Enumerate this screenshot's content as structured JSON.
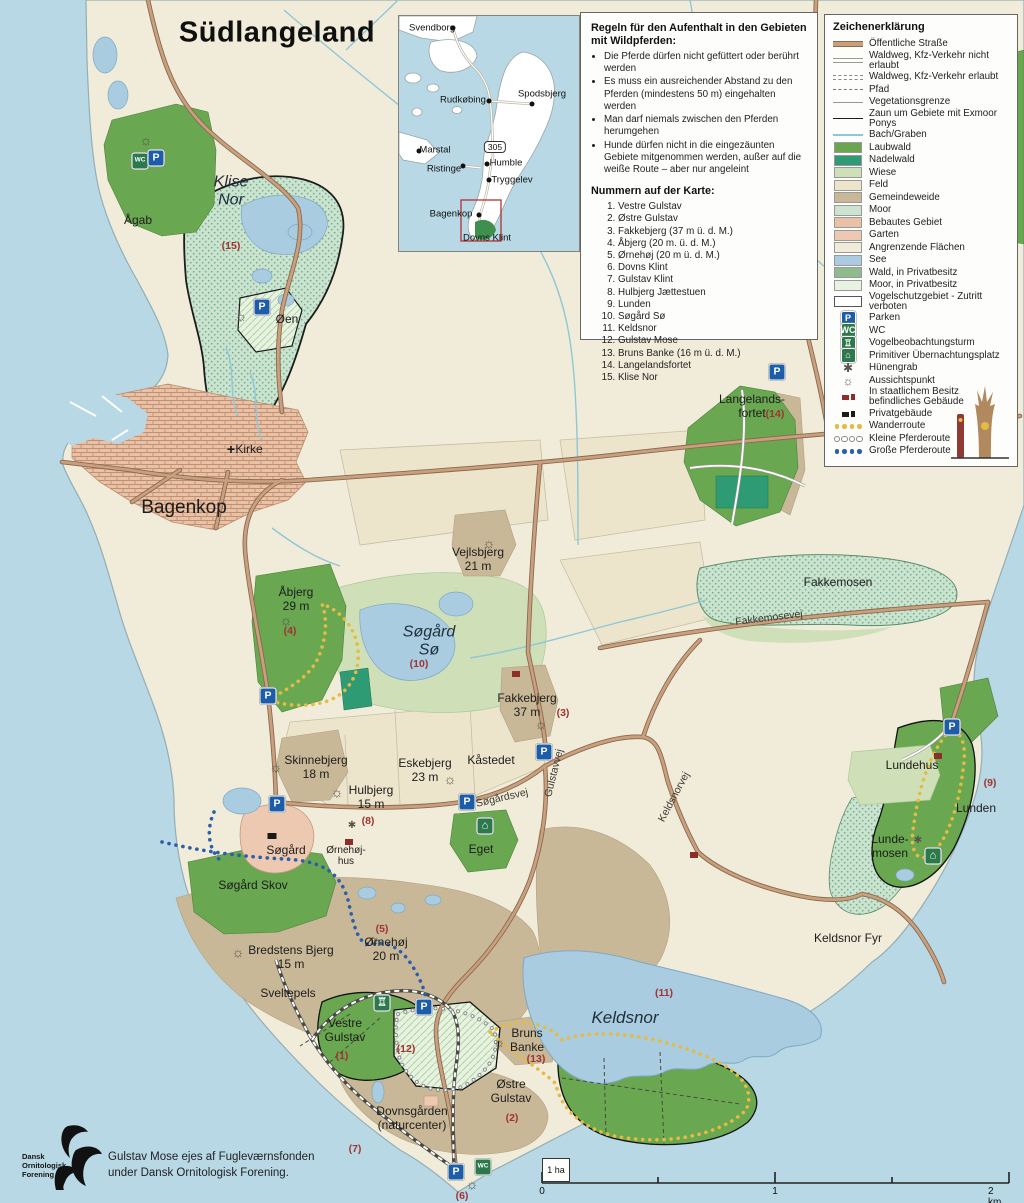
{
  "colors": {
    "sea": "#b7d8e4",
    "land": "#f1ecd9",
    "laubwald": "#69a750",
    "nadelwald": "#2f9b74",
    "wiese": "#cfe0b8",
    "feld": "#ece5cc",
    "gemeindeweide": "#c9b897",
    "moor": "#cbe3cf",
    "bebaut": "#e9c2a6",
    "garten": "#ecc9b0",
    "see": "#a9cce0",
    "wald_privat": "#8dbb8d",
    "road": "#c9a07e",
    "road_edge": "#8a6950",
    "parking_blue": "#1d5ca6",
    "wc_green": "#2c7a4c",
    "red_number": "#a03432",
    "route_yellow": "#e3bb45",
    "route_blue": "#2b5fa7"
  },
  "icon_defs": {
    "parking": {
      "glyph": "P",
      "bg": "#1d5ca6",
      "fg": "#ffffff"
    },
    "wc": {
      "glyph": "WC",
      "bg": "#2c7a4c",
      "fg": "#ffffff"
    },
    "tower": {
      "glyph": "♖",
      "bg": "#2c7a4c",
      "fg": "#ffffff"
    },
    "shelter": {
      "glyph": "⌂",
      "bg": "#2c7a4c",
      "fg": "#ffffff"
    },
    "viewpoint": {
      "glyph": "☼"
    },
    "huenengrab": {
      "glyph": "✱"
    },
    "church": {
      "glyph": "+"
    },
    "state-building": {
      "bg": "#8f2d2b"
    },
    "private-building": {
      "bg": "#1a1a1a"
    }
  },
  "inset": {
    "route_badge": "305",
    "towns": [
      {
        "name": "Svendborg",
        "lx": 33,
        "ly": 12,
        "dx": 54,
        "dy": 12
      },
      {
        "name": "Rudkøbing",
        "lx": 64,
        "ly": 84,
        "dx": 90,
        "dy": 85
      },
      {
        "name": "Spodsbjerg",
        "lx": 143,
        "ly": 78,
        "dx": 133,
        "dy": 88
      },
      {
        "name": "Marstal",
        "lx": 36,
        "ly": 134,
        "dx": 20,
        "dy": 135
      },
      {
        "name": "Ristinge",
        "lx": 45,
        "ly": 153,
        "dx": 64,
        "dy": 150
      },
      {
        "name": "Humble",
        "lx": 107,
        "ly": 147,
        "dx": 88,
        "dy": 148
      },
      {
        "name": "Tryggelev",
        "lx": 113,
        "ly": 164,
        "dx": 90,
        "dy": 164
      },
      {
        "name": "Bagenkop",
        "lx": 52,
        "ly": 198,
        "dx": 80,
        "dy": 199
      },
      {
        "name": "Dovns Klint",
        "lx": 88,
        "ly": 222,
        "dx": null,
        "dy": null
      }
    ]
  },
  "rules": {
    "heading": "Regeln für den Aufenthalt in den Gebieten mit Wildpferden:",
    "bullets": [
      "Die Pferde dürfen nicht gefüttert oder berührt werden",
      "Es muss ein ausreichender Abstand zu den Pferden (mindestens 50 m) eingehalten werden",
      "Man darf niemals zwischen den Pferden herumgehen",
      "Hunde dürfen nicht in die eingezäunten Gebiete mitgenommen werden, außer auf die weiße Route – aber nur angeleint"
    ],
    "numbers_heading": "Nummern auf der Karte:",
    "numbers": [
      "Vestre Gulstav",
      "Østre Gulstav",
      "Fakkebjerg (37 m ü. d. M.)",
      "Åbjerg (20 m. ü. d. M.)",
      "Ørnehøj (20 m ü. d. M.)",
      "Dovns Klint",
      "Gulstav Klint",
      "Hulbjerg Jættestuen",
      "Lunden",
      "Søgård Sø",
      "Keldsnor",
      "Gulstav Mose",
      "Bruns Banke (16 m ü. d. M.)",
      "Langelandsfortet",
      "Klise Nor"
    ]
  },
  "legend": {
    "heading": "Zeichenerklärung",
    "items": [
      {
        "label": "Öffentliche Straße",
        "sw": {
          "k": "road"
        }
      },
      {
        "label": "Waldweg, Kfz-Verkehr nicht erlaubt",
        "sw": {
          "k": "wald"
        }
      },
      {
        "label": "Waldweg, Kfz-Verkehr erlaubt",
        "sw": {
          "k": "waldk"
        }
      },
      {
        "label": "Pfad",
        "sw": {
          "k": "pfad"
        }
      },
      {
        "label": "Vegetationsgrenze",
        "sw": {
          "k": "veg"
        }
      },
      {
        "label": "Zaun um Gebiete mit Exmoor Ponys",
        "sw": {
          "k": "zaun"
        }
      },
      {
        "label": "Bach/Graben",
        "sw": {
          "k": "bach"
        }
      },
      {
        "label": "Laubwald",
        "sw": {
          "k": "fill",
          "c": "#6aa64f"
        }
      },
      {
        "label": "Nadelwald",
        "sw": {
          "k": "fill",
          "c": "#2f9b74"
        }
      },
      {
        "label": "Wiese",
        "sw": {
          "k": "fill",
          "c": "#cfe0b8"
        }
      },
      {
        "label": "Feld",
        "sw": {
          "k": "fill",
          "c": "#ece5cc"
        }
      },
      {
        "label": "Gemeindeweide",
        "sw": {
          "k": "fill",
          "c": "#c9b897"
        }
      },
      {
        "label": "Moor",
        "sw": {
          "k": "fill",
          "c": "#cbe3cf",
          "p": "dots"
        }
      },
      {
        "label": "Bebautes Gebiet",
        "sw": {
          "k": "fill",
          "c": "#e9c2a6",
          "p": "brick"
        }
      },
      {
        "label": "Garten",
        "sw": {
          "k": "fill",
          "c": "#ecc9b0"
        }
      },
      {
        "label": "Angrenzende Flächen",
        "sw": {
          "k": "fill",
          "c": "#f1ecd9"
        }
      },
      {
        "label": "See",
        "sw": {
          "k": "fill",
          "c": "#a9cce0"
        }
      },
      {
        "label": "Wald, in Privatbesitz",
        "sw": {
          "k": "fill",
          "c": "#8dbb8d"
        }
      },
      {
        "label": "Moor, in Privatbesitz",
        "sw": {
          "k": "fill",
          "c": "#e7f2e0",
          "p": "hatchg"
        }
      },
      {
        "label": "Vogelschutzgebiet - Zutritt verboten",
        "sw": {
          "k": "fill",
          "c": "#ffffff",
          "p": "diag",
          "b": 1
        }
      },
      {
        "label": "Parken",
        "sw": {
          "k": "icon",
          "t": "parking"
        }
      },
      {
        "label": "WC",
        "sw": {
          "k": "icon",
          "t": "wc"
        }
      },
      {
        "label": "Vogelbeobachtungsturm",
        "sw": {
          "k": "icon",
          "t": "tower"
        }
      },
      {
        "label": "Primitiver Übernachtungsplatz",
        "sw": {
          "k": "icon",
          "t": "shelter"
        }
      },
      {
        "label": "Hünengrab",
        "sw": {
          "k": "sym",
          "t": "huenengrab"
        }
      },
      {
        "label": "Aussichtspunkt",
        "sw": {
          "k": "sym",
          "t": "viewpoint"
        }
      },
      {
        "label": "In staatlichem Besitz\nbefindliches Gebäude",
        "sw": {
          "k": "bld",
          "c": "#8f2d2b"
        }
      },
      {
        "label": "Privatgebäude",
        "sw": {
          "k": "bld",
          "c": "#1a1a1a"
        }
      },
      {
        "label": "Wanderroute",
        "sw": {
          "k": "dots",
          "c": "#e3bb45"
        }
      },
      {
        "label": "Kleine Pferderoute",
        "sw": {
          "k": "dots",
          "c": "#ffffff",
          "ring": "#8a8a8a"
        }
      },
      {
        "label": "Große Pferderoute",
        "sw": {
          "k": "dots",
          "c": "#2b5fa7"
        }
      }
    ]
  },
  "map": {
    "labels": [
      {
        "text": "Südlangeland",
        "x": 277,
        "y": 33,
        "cls": "title",
        "name": "page-title"
      },
      {
        "text": "Klise\nNor",
        "x": 231,
        "y": 192,
        "cls": "water"
      },
      {
        "text": "Ågab",
        "x": 138,
        "y": 221,
        "cls": "place"
      },
      {
        "text": "(15)",
        "x": 231,
        "y": 246,
        "cls": "num"
      },
      {
        "text": "Øen",
        "x": 287,
        "y": 320,
        "cls": "place"
      },
      {
        "text": "Kirke",
        "x": 249,
        "y": 450,
        "cls": "place"
      },
      {
        "text": "Bagenkop",
        "x": 184,
        "y": 508,
        "cls": "town"
      },
      {
        "text": "Vejlsbjerg\n21 m",
        "x": 478,
        "y": 560,
        "cls": "place"
      },
      {
        "text": "Åbjerg\n29 m",
        "x": 296,
        "y": 600,
        "cls": "place"
      },
      {
        "text": "(4)",
        "x": 290,
        "y": 631,
        "cls": "num"
      },
      {
        "text": "Søgård\nSø",
        "x": 429,
        "y": 642,
        "cls": "water"
      },
      {
        "text": "(10)",
        "x": 419,
        "y": 664,
        "cls": "num"
      },
      {
        "text": "Fakkebjerg\n37 m",
        "x": 527,
        "y": 706,
        "cls": "place"
      },
      {
        "text": "(3)",
        "x": 563,
        "y": 713,
        "cls": "num"
      },
      {
        "text": "Fakkemosen",
        "x": 838,
        "y": 583,
        "cls": "place"
      },
      {
        "text": "Fakkemosevej",
        "x": 769,
        "y": 618,
        "cls": "roadlbl",
        "rot": -7
      },
      {
        "text": "Langelands-\nfortet",
        "x": 752,
        "y": 407,
        "cls": "place"
      },
      {
        "text": "(14)",
        "x": 775,
        "y": 414,
        "cls": "num"
      },
      {
        "text": "Skinnebjerg\n18 m",
        "x": 316,
        "y": 768,
        "cls": "place"
      },
      {
        "text": "Eskebjerg\n23 m",
        "x": 425,
        "y": 771,
        "cls": "place"
      },
      {
        "text": "Kåstedet",
        "x": 491,
        "y": 761,
        "cls": "place"
      },
      {
        "text": "Hulbjerg\n15 m",
        "x": 371,
        "y": 798,
        "cls": "place"
      },
      {
        "text": "(8)",
        "x": 368,
        "y": 821,
        "cls": "num"
      },
      {
        "text": "Søgårdsvej",
        "x": 502,
        "y": 798,
        "cls": "roadlbl",
        "rot": -13
      },
      {
        "text": "Gulstavvej",
        "x": 554,
        "y": 773,
        "cls": "roadlbl",
        "rot": -76
      },
      {
        "text": "Keldsnorvej",
        "x": 674,
        "y": 797,
        "cls": "roadlbl",
        "rot": -62
      },
      {
        "text": "Søgård",
        "x": 286,
        "y": 851,
        "cls": "place"
      },
      {
        "text": "Ørnehøj-\nhus",
        "x": 346,
        "y": 856,
        "cls": "small"
      },
      {
        "text": "Eget",
        "x": 481,
        "y": 850,
        "cls": "place"
      },
      {
        "text": "Søgård Skov",
        "x": 253,
        "y": 886,
        "cls": "place"
      },
      {
        "text": "Bredstens Bjerg\n15 m",
        "x": 291,
        "y": 958,
        "cls": "place"
      },
      {
        "text": "Ørnehøj\n20 m",
        "x": 386,
        "y": 950,
        "cls": "place"
      },
      {
        "text": "(5)",
        "x": 382,
        "y": 929,
        "cls": "num"
      },
      {
        "text": "Sveltepels",
        "x": 288,
        "y": 994,
        "cls": "place"
      },
      {
        "text": "Keldsnor Fyr",
        "x": 848,
        "y": 939,
        "cls": "place"
      },
      {
        "text": "Keldsnor",
        "x": 625,
        "y": 1018,
        "cls": "water-lg"
      },
      {
        "text": "(11)",
        "x": 664,
        "y": 993,
        "cls": "num"
      },
      {
        "text": "Lundehus",
        "x": 912,
        "y": 766,
        "cls": "place"
      },
      {
        "text": "Lunden",
        "x": 976,
        "y": 809,
        "cls": "place"
      },
      {
        "text": "(9)",
        "x": 990,
        "y": 783,
        "cls": "num"
      },
      {
        "text": "Lunde-\nmosen",
        "x": 890,
        "y": 847,
        "cls": "place"
      },
      {
        "text": "Vestre\nGulstav",
        "x": 345,
        "y": 1031,
        "cls": "place"
      },
      {
        "text": "(1)",
        "x": 342,
        "y": 1056,
        "cls": "num"
      },
      {
        "text": "(12)",
        "x": 406,
        "y": 1049,
        "cls": "num"
      },
      {
        "text": "Bruns\nBanke",
        "x": 527,
        "y": 1041,
        "cls": "place"
      },
      {
        "text": "(13)",
        "x": 536,
        "y": 1059,
        "cls": "num"
      },
      {
        "text": "Østre\nGulstav",
        "x": 511,
        "y": 1092,
        "cls": "place"
      },
      {
        "text": "(2)",
        "x": 512,
        "y": 1118,
        "cls": "num"
      },
      {
        "text": "Dovnsgården\n(naturcenter)",
        "x": 412,
        "y": 1119,
        "cls": "place"
      },
      {
        "text": "(7)",
        "x": 355,
        "y": 1149,
        "cls": "num"
      },
      {
        "text": "(6)",
        "x": 462,
        "y": 1196,
        "cls": "num"
      }
    ],
    "icons": [
      {
        "t": "wc",
        "x": 140,
        "y": 161
      },
      {
        "t": "parking",
        "x": 156,
        "y": 158
      },
      {
        "t": "viewpoint",
        "x": 146,
        "y": 140
      },
      {
        "t": "parking",
        "x": 262,
        "y": 307
      },
      {
        "t": "viewpoint",
        "x": 241,
        "y": 316
      },
      {
        "t": "church",
        "x": 231,
        "y": 449
      },
      {
        "t": "viewpoint",
        "x": 489,
        "y": 543
      },
      {
        "t": "viewpoint",
        "x": 286,
        "y": 620
      },
      {
        "t": "parking",
        "x": 268,
        "y": 696
      },
      {
        "t": "viewpoint",
        "x": 541,
        "y": 724
      },
      {
        "t": "state-building",
        "x": 516,
        "y": 674
      },
      {
        "t": "parking",
        "x": 777,
        "y": 372
      },
      {
        "t": "viewpoint",
        "x": 276,
        "y": 767
      },
      {
        "t": "viewpoint",
        "x": 337,
        "y": 792
      },
      {
        "t": "viewpoint",
        "x": 450,
        "y": 779
      },
      {
        "t": "huenengrab",
        "x": 352,
        "y": 826
      },
      {
        "t": "parking",
        "x": 277,
        "y": 804
      },
      {
        "t": "parking",
        "x": 467,
        "y": 802
      },
      {
        "t": "parking",
        "x": 544,
        "y": 752
      },
      {
        "t": "state-building",
        "x": 349,
        "y": 842
      },
      {
        "t": "shelter",
        "x": 485,
        "y": 826
      },
      {
        "t": "private-building",
        "x": 272,
        "y": 836
      },
      {
        "t": "viewpoint",
        "x": 238,
        "y": 952
      },
      {
        "t": "viewpoint",
        "x": 374,
        "y": 939
      },
      {
        "t": "parking",
        "x": 952,
        "y": 727
      },
      {
        "t": "state-building",
        "x": 938,
        "y": 756
      },
      {
        "t": "huenengrab",
        "x": 918,
        "y": 841
      },
      {
        "t": "shelter",
        "x": 933,
        "y": 856
      },
      {
        "t": "tower",
        "x": 382,
        "y": 1003
      },
      {
        "t": "parking",
        "x": 424,
        "y": 1007
      },
      {
        "t": "viewpoint",
        "x": 499,
        "y": 1042
      },
      {
        "t": "state-building",
        "x": 694,
        "y": 855
      },
      {
        "t": "parking",
        "x": 456,
        "y": 1172
      },
      {
        "t": "wc",
        "x": 483,
        "y": 1167
      },
      {
        "t": "viewpoint",
        "x": 472,
        "y": 1184
      }
    ]
  },
  "credit": {
    "logo_text": "Dansk\nOrnitologisk\nForening",
    "text": "Gulstav Mose ejes af Fugleværnsfonden\nunder Dansk Ornitologisk Forening."
  },
  "scalebar": {
    "hectare": "1 ha",
    "t0": "0",
    "t1": "1",
    "t2": "2 km"
  }
}
